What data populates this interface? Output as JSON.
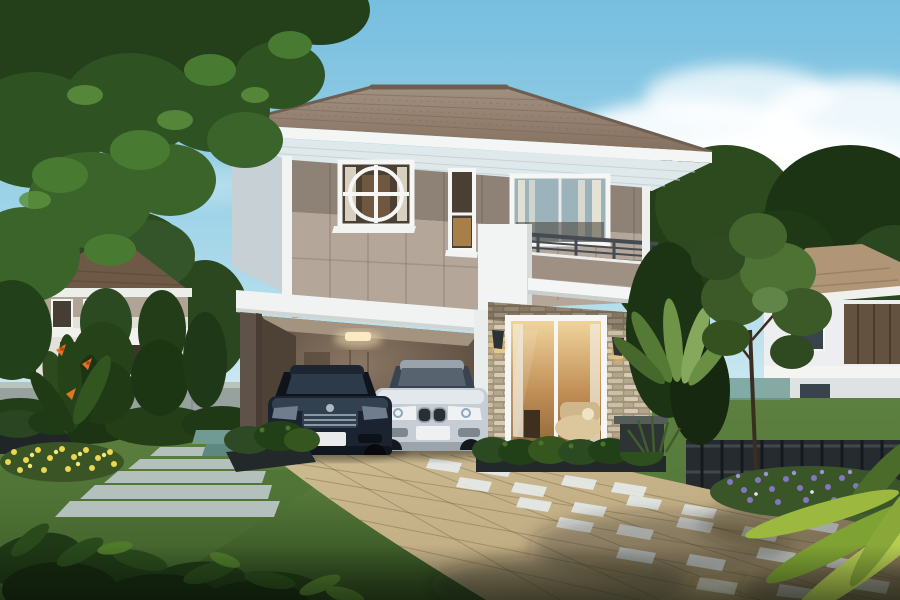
{
  "scene": {
    "type": "architectural-exterior-render",
    "description": "Two-story modern tropical house with tiled hip roof, circular feature window, balcony, stone-clad living room wall, carport with a dark sedan and a silver sedan, tiled driveway with white accent pavers, green lawn, flower beds, hedges, neighboring houses and big tree under a blue sky with clouds",
    "objects": [
      "sky",
      "clouds",
      "overhanging-tree",
      "left-neighbor-house",
      "right-neighbor-house",
      "concrete-fence-wall",
      "metal-fence",
      "main-house-roof",
      "second-floor-wall",
      "circle-feature-window",
      "narrow-window",
      "balcony",
      "balcony-railing",
      "carport",
      "ceiling-lamp",
      "dark-sedan",
      "silver-sedan",
      "stone-veneer-wall",
      "sliding-glass-door",
      "wall-sconces",
      "hedge",
      "planter-boxes",
      "stone-walkway",
      "tiled-driveway",
      "white-pavers",
      "lawn",
      "yellow-flowers",
      "purple-flowers",
      "bird-of-paradise",
      "palm-fronds",
      "garden-tree",
      "foreground-shrubs"
    ]
  },
  "palette": {
    "sky_top": "#76bedf",
    "sky_mid": "#a9d9ea",
    "sky_horizon": "#e6f2f4",
    "cloud": "#ffffff",
    "foliage_dark": "#1d3414",
    "foliage": "#2c4a1d",
    "foliage_light": "#477230",
    "foliage_bright": "#5f8c3c",
    "grass": "#567a3a",
    "grass_dark": "#2c451d",
    "roof_main": "#97846f",
    "roof_shadow": "#77655a",
    "roof_bg_left": "#6e5946",
    "roof_bg_right": "#b09676",
    "fascia": "#f4f6f5",
    "soffit": "#dfe9eb",
    "wall_upper": "#8e8276",
    "wall_lower": "#b4a698",
    "wall_side": "#c6d0d5",
    "band_white": "#f1f3f2",
    "pillar_dark": "#5f5248",
    "carport_warm": "#8a7664",
    "carport_dark": "#453a2f",
    "stone": "#c9bda5",
    "stone_dark": "#a2947a",
    "stone_light": "#ded4bf",
    "glass_dark": "#4a3f33",
    "glass_warm": "#c19057",
    "curtain": "#f0ead9",
    "rail_metal": "#454b52",
    "balcony_panel": "#9e9082",
    "car_dark": "#1b2330",
    "car_silver": "#c6cdd4",
    "drive": "#c2ae85",
    "drive_dark": "#8d7a58",
    "tile_white": "#e7edee",
    "walkway": "#b4c0bb",
    "flower_yellow": "#ead84e",
    "flower_purple": "#8377c2",
    "flower_orange": "#e0761f",
    "fence_wall": "#97a19d",
    "fence_metal": "#262b2f",
    "step_teal": "#6f9b94"
  }
}
